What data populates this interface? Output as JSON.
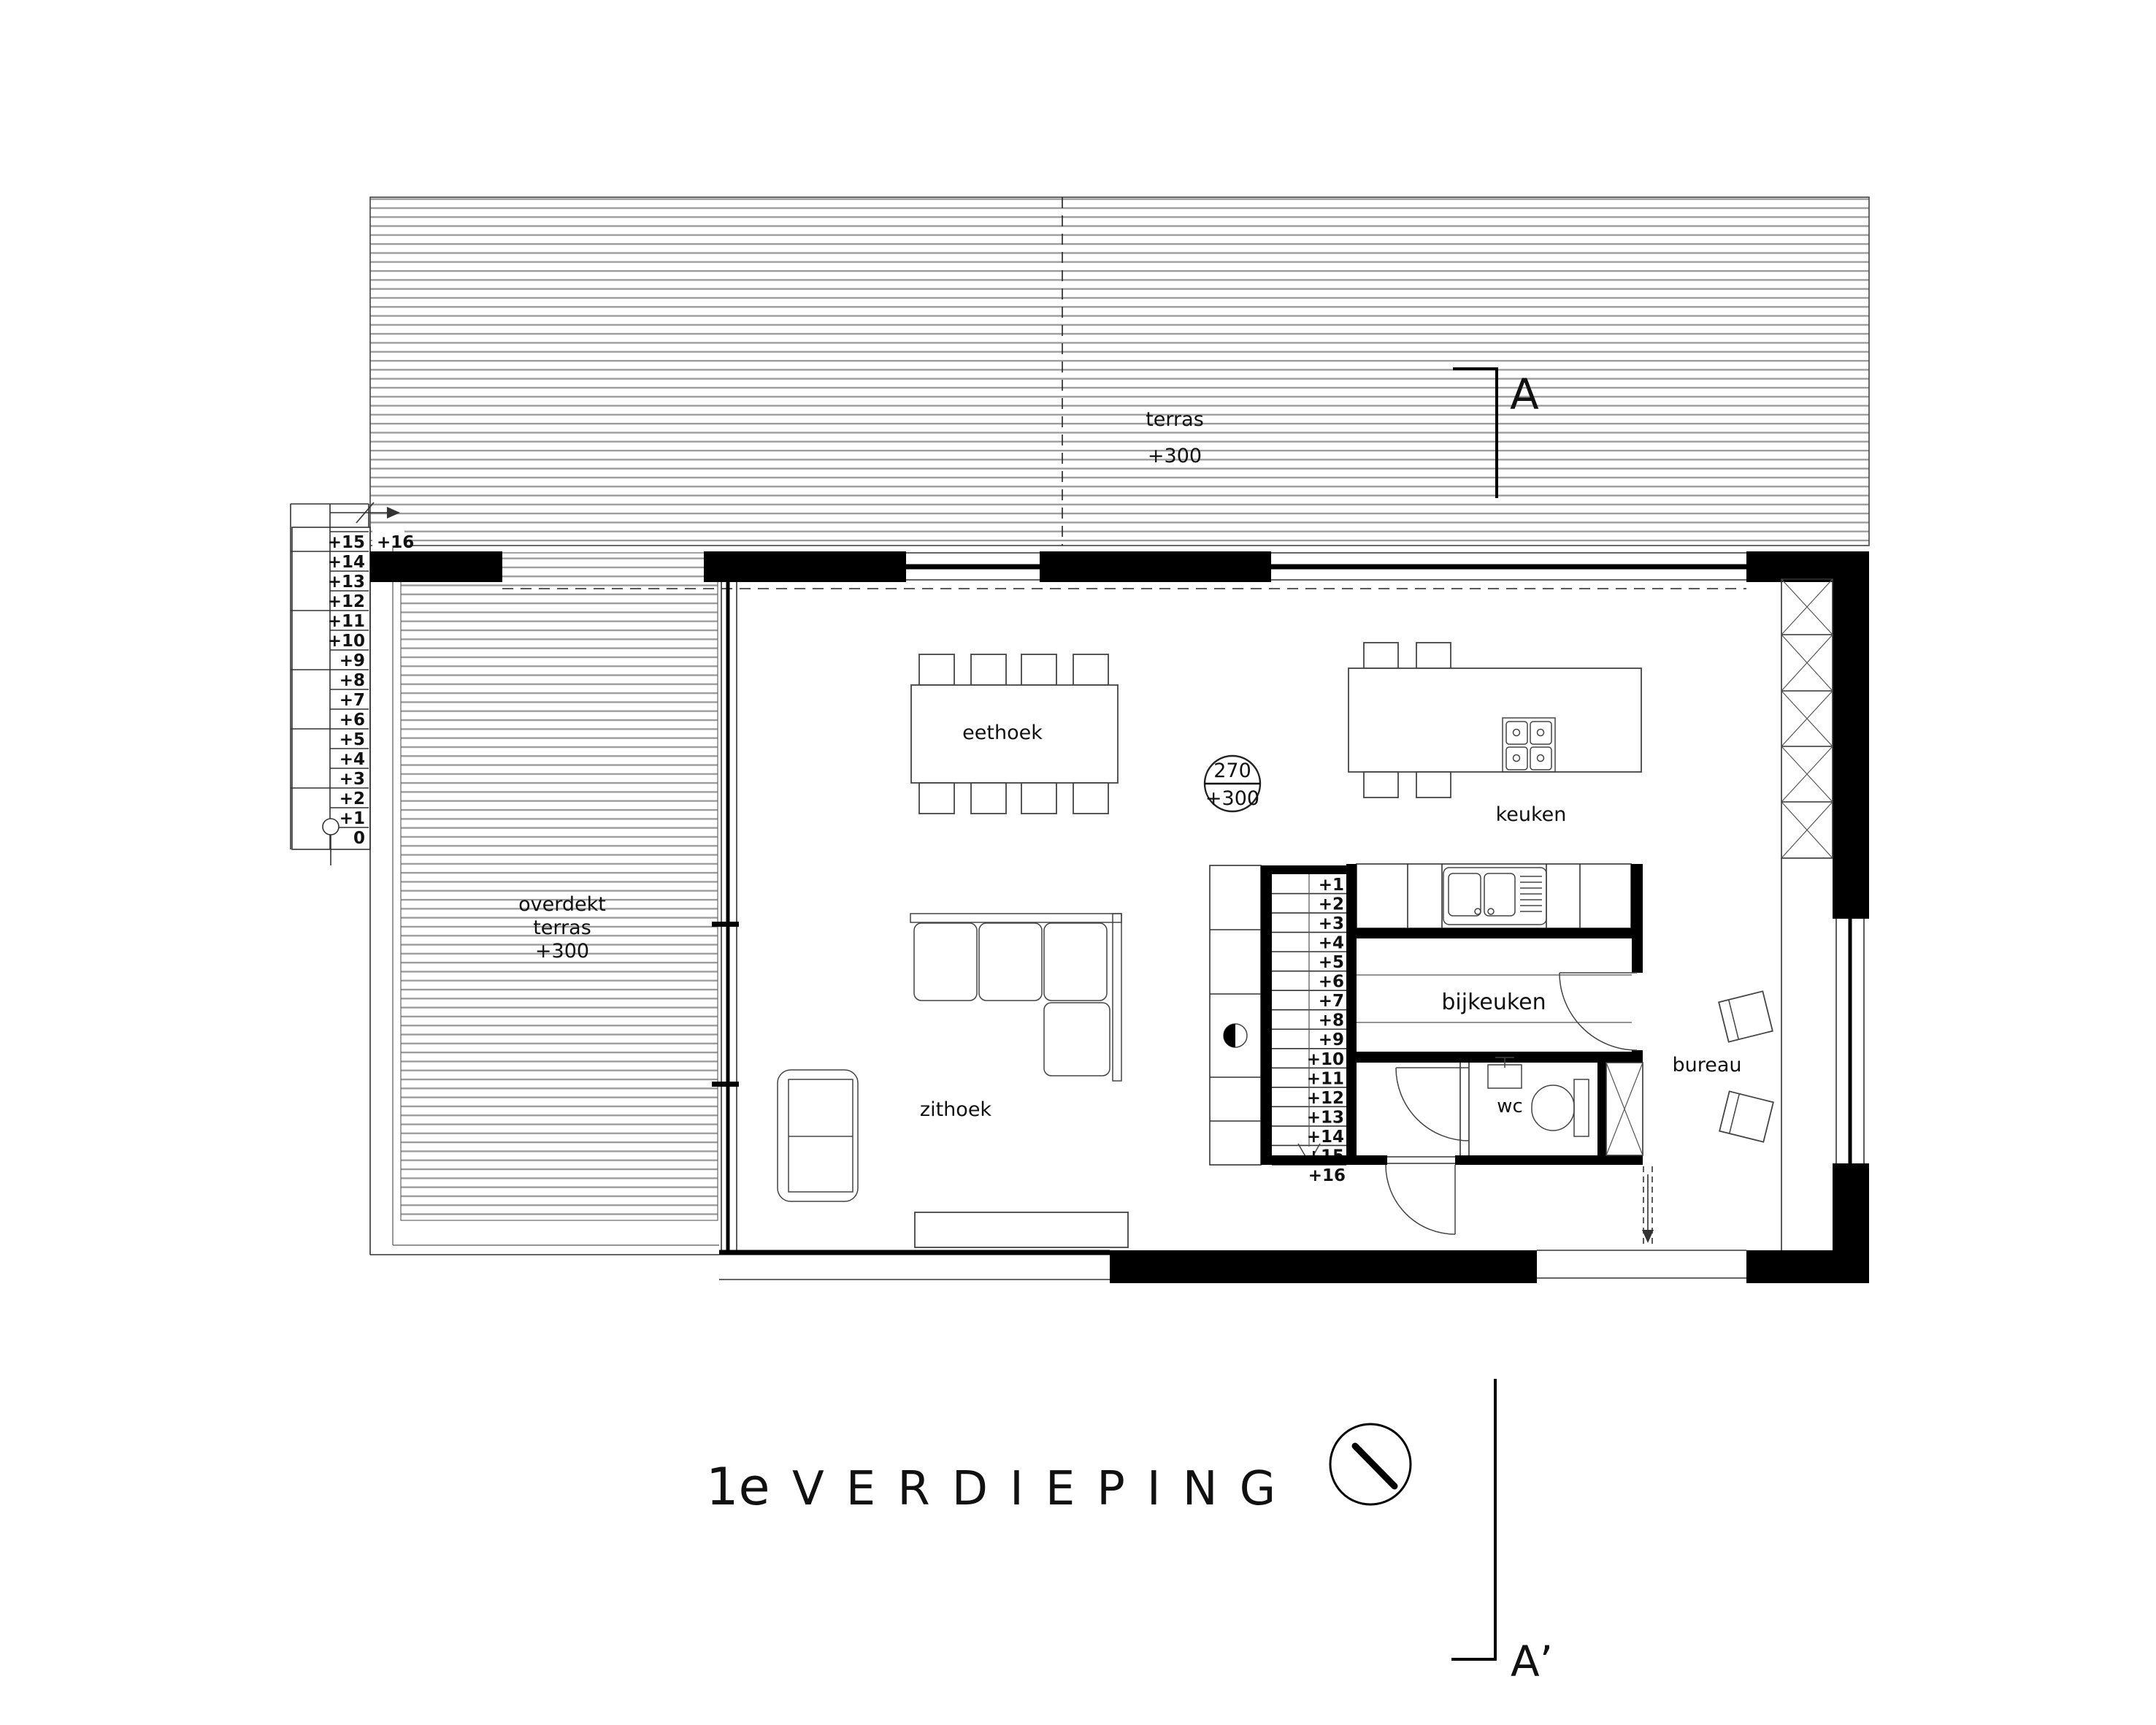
{
  "title": {
    "prefix": "1e",
    "name": "VERDIEPING"
  },
  "section_markers": {
    "start": "A",
    "end": "A’"
  },
  "annotations": {
    "level_circle": {
      "top": "270",
      "bottom": "+300"
    }
  },
  "rooms": {
    "terras": {
      "name": "terras",
      "level": "+300"
    },
    "overdekt_terras": {
      "line1": "overdekt",
      "line2": "terras",
      "level": "+300"
    },
    "eethoek": {
      "name": "eethoek"
    },
    "keuken": {
      "name": "keuken"
    },
    "zithoek": {
      "name": "zithoek"
    },
    "bijkeuken": {
      "name": "bijkeuken"
    },
    "wc": {
      "name": "wc"
    },
    "bureau": {
      "name": "bureau"
    }
  },
  "stairs": {
    "left": {
      "steps": [
        "+15",
        "+14",
        "+13",
        "+12",
        "+11",
        "+10",
        "+9",
        "+8",
        "+7",
        "+6",
        "+5",
        "+4",
        "+3",
        "+2",
        "+1",
        "0"
      ],
      "landing": "+16"
    },
    "main": {
      "steps": [
        "+1",
        "+2",
        "+3",
        "+4",
        "+5",
        "+6",
        "+7",
        "+8",
        "+9",
        "+10",
        "+11",
        "+12",
        "+13",
        "+14",
        "+15"
      ],
      "landing": "+16"
    }
  },
  "colors": {
    "ink": "#111111",
    "hatch": "#9a9a9a",
    "wall": "#000000"
  }
}
